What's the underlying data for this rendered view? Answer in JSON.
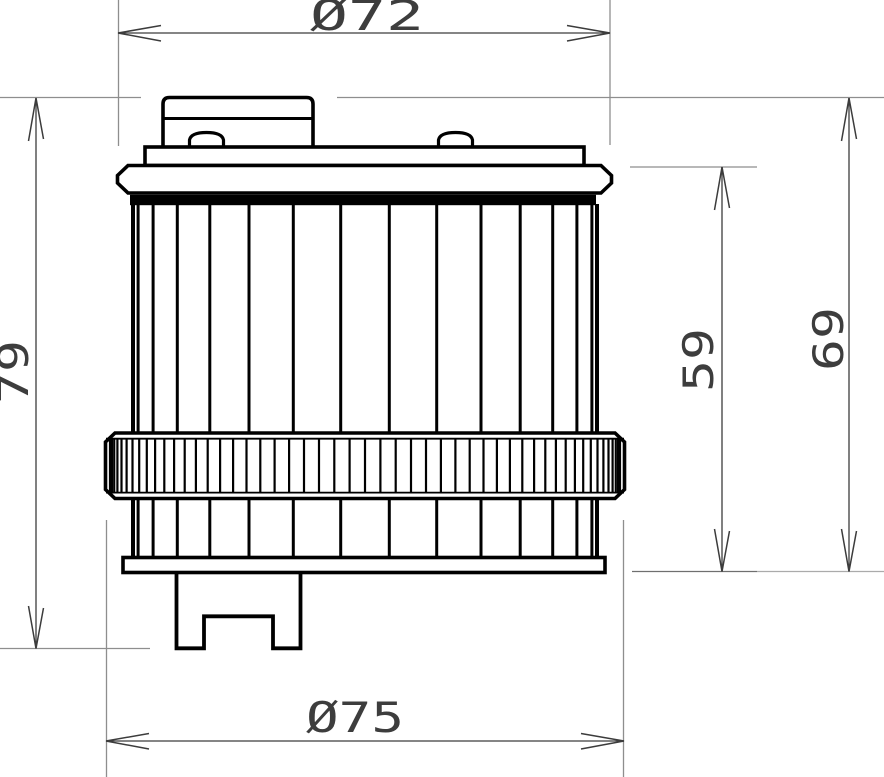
{
  "page": {
    "title": "Oil filter element - dimensioned side view technical drawing",
    "background": "#ffffff"
  },
  "colors": {
    "part_outline": "#000000",
    "part_fill": "#ffffff",
    "gasket_fill": "#000000",
    "extension_line": "#8e8e8e",
    "extension_line_dark": "#6f6f6f",
    "extension_line_light": "#ababab",
    "dimension_line": "#3c3c3c",
    "dimension_text": "#3d3d3d"
  },
  "dimensions": {
    "top_diameter": {
      "label": "Ø72",
      "orientation": "horizontal",
      "measures": "flange diameter"
    },
    "bottom_diameter": {
      "label": "Ø75",
      "orientation": "horizontal",
      "measures": "knurled band diameter"
    },
    "overall_height": {
      "label": "79",
      "orientation": "vertical",
      "measures": "cap top to fitting bottom"
    },
    "cap_to_base_height": {
      "label": "69",
      "orientation": "vertical",
      "measures": "cap top to base plate bottom"
    },
    "body_height": {
      "label": "59",
      "orientation": "vertical",
      "measures": "flange top to base plate bottom"
    }
  },
  "geometry": {
    "pleat_divisions": 15,
    "knurl_divisions": 52,
    "body_center_x": 365,
    "pleat_radius": 232,
    "knurl_radius": 255
  }
}
